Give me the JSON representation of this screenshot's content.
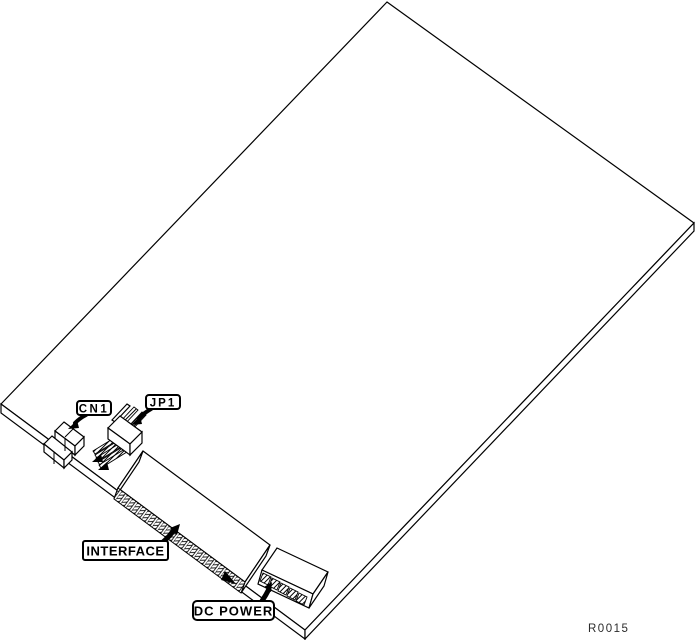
{
  "illustration": {
    "callouts": {
      "cn1": {
        "label": "CN1"
      },
      "jp1": {
        "label": "JP1"
      },
      "interface": {
        "label": "INTERFACE"
      },
      "dc_power": {
        "label": "DC POWER"
      }
    },
    "ref_code": "R0015",
    "colors": {
      "line": "#000000",
      "background": "#ffffff"
    }
  }
}
